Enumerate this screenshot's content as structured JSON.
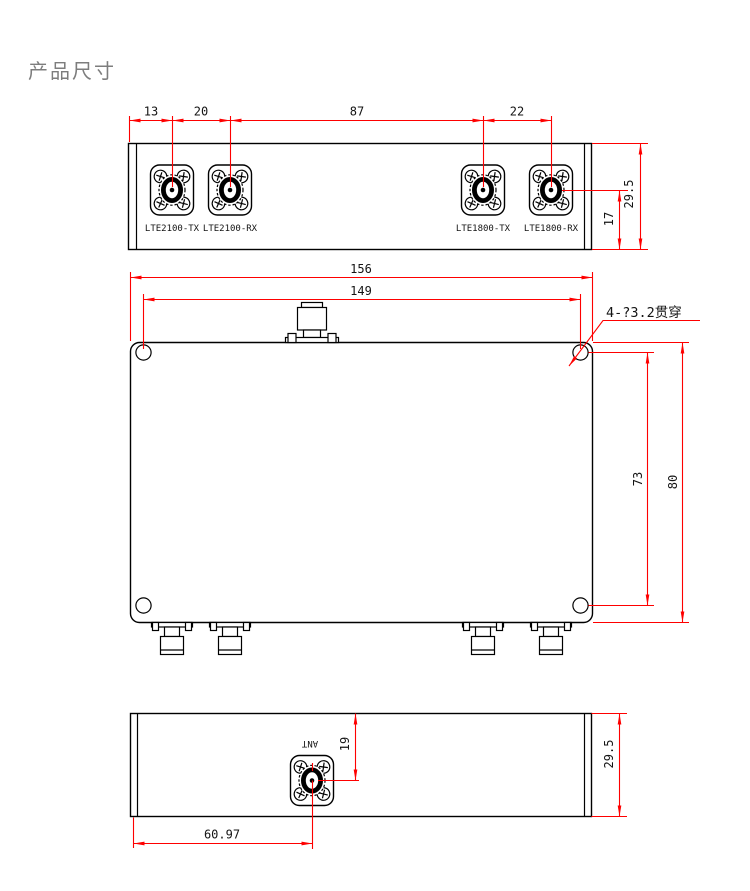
{
  "title": "产品尺寸",
  "colors": {
    "outline": "#000000",
    "dimension": "#fe0000",
    "title_text": "#7d7d7d",
    "background": "#ffffff"
  },
  "top_view": {
    "description": "top face with four RF ports",
    "connector_labels": [
      "LTE2100-TX",
      "LTE2100-RX",
      "LTE1800-TX",
      "LTE1800-RX"
    ],
    "dim_13": "13",
    "dim_20": "20",
    "dim_87": "87",
    "dim_22": "22",
    "dim_17": "17",
    "dim_29_5": "29.5"
  },
  "front_view": {
    "description": "main face with mounting holes and ANT port on edge",
    "dim_156": "156",
    "dim_149": "149",
    "dim_73": "73",
    "dim_80": "80",
    "hole_note": "4-?3.2贯穿"
  },
  "bottom_view": {
    "port_label": "ANT",
    "dim_19": "19",
    "dim_29_5": "29.5",
    "dim_60_97": "60.97"
  }
}
